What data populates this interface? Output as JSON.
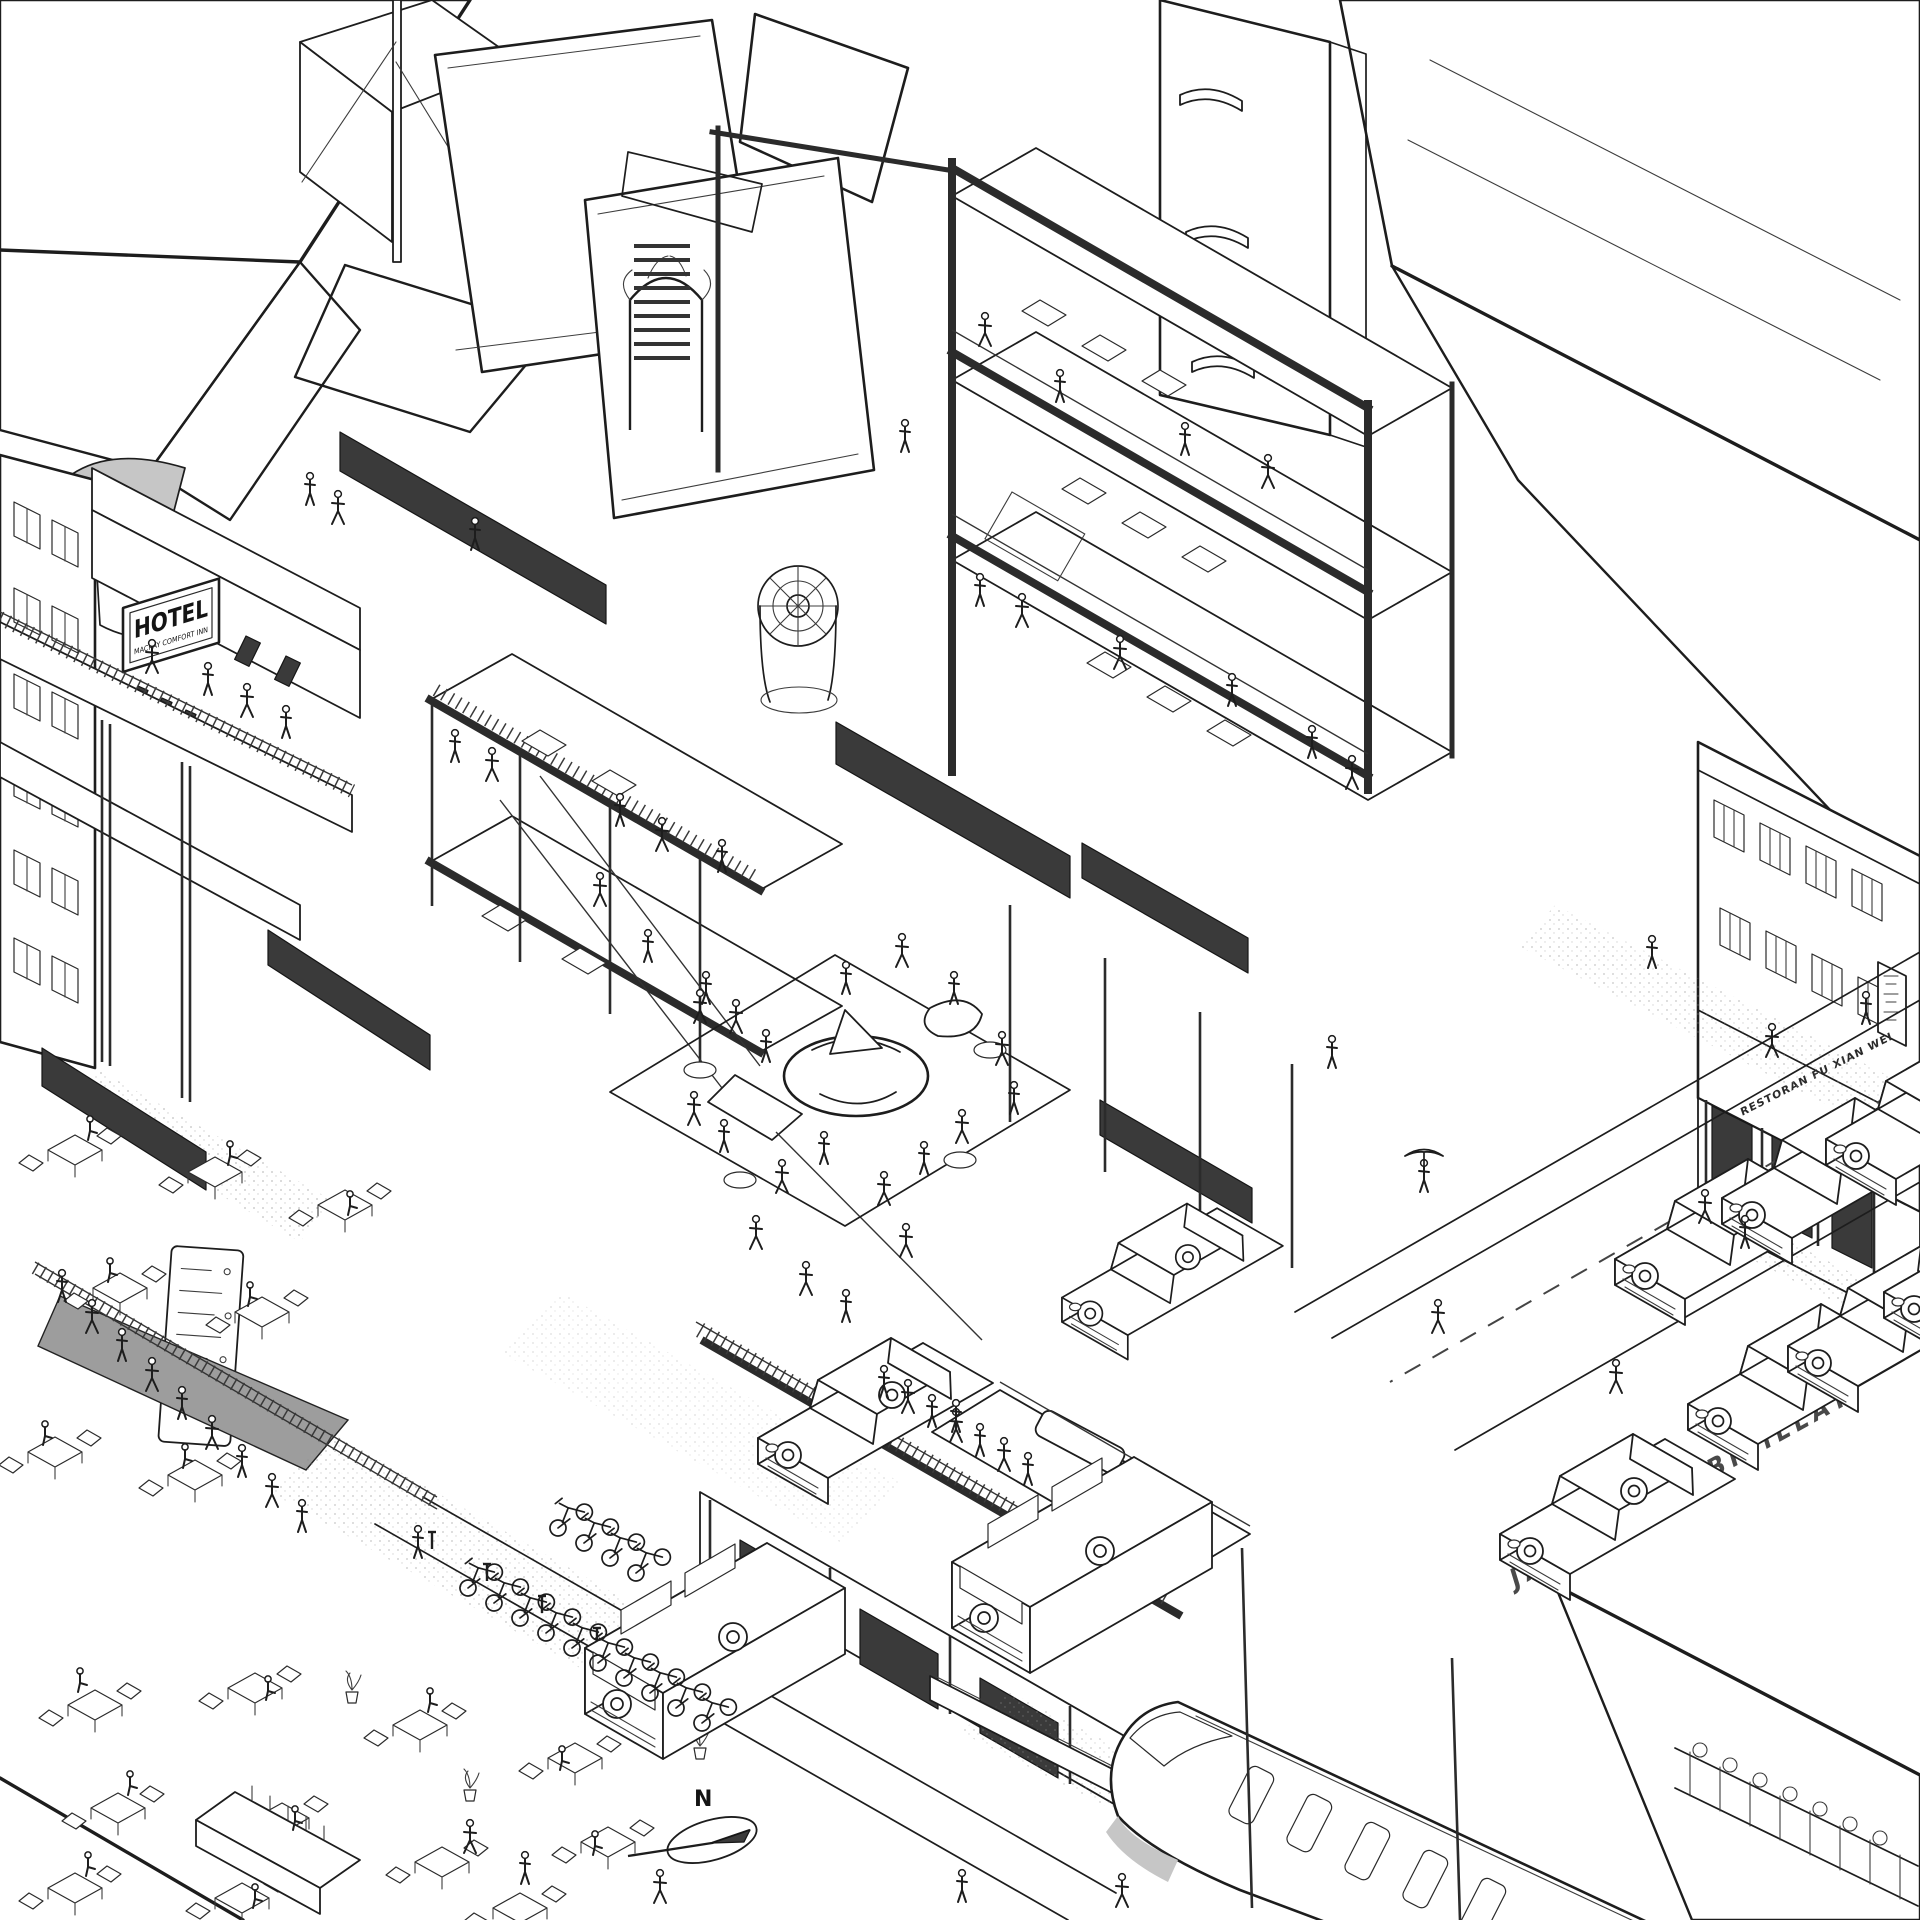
{
  "labels": {
    "hotel_sign": "HOTEL",
    "hotel_sign_subtitle": "MACKAY COMFORT INN",
    "street_name": "JALAN THAMBIPILLAY",
    "restaurant_sign": "RESTORAN FU XIAN WEI",
    "north_indicator": "N"
  },
  "colors": {
    "ink": "#1d1d1d",
    "paper": "#ffffff",
    "poche": "#3a3a3a",
    "shade": "#c6c6c6",
    "stipple": "#9a9a9a"
  }
}
